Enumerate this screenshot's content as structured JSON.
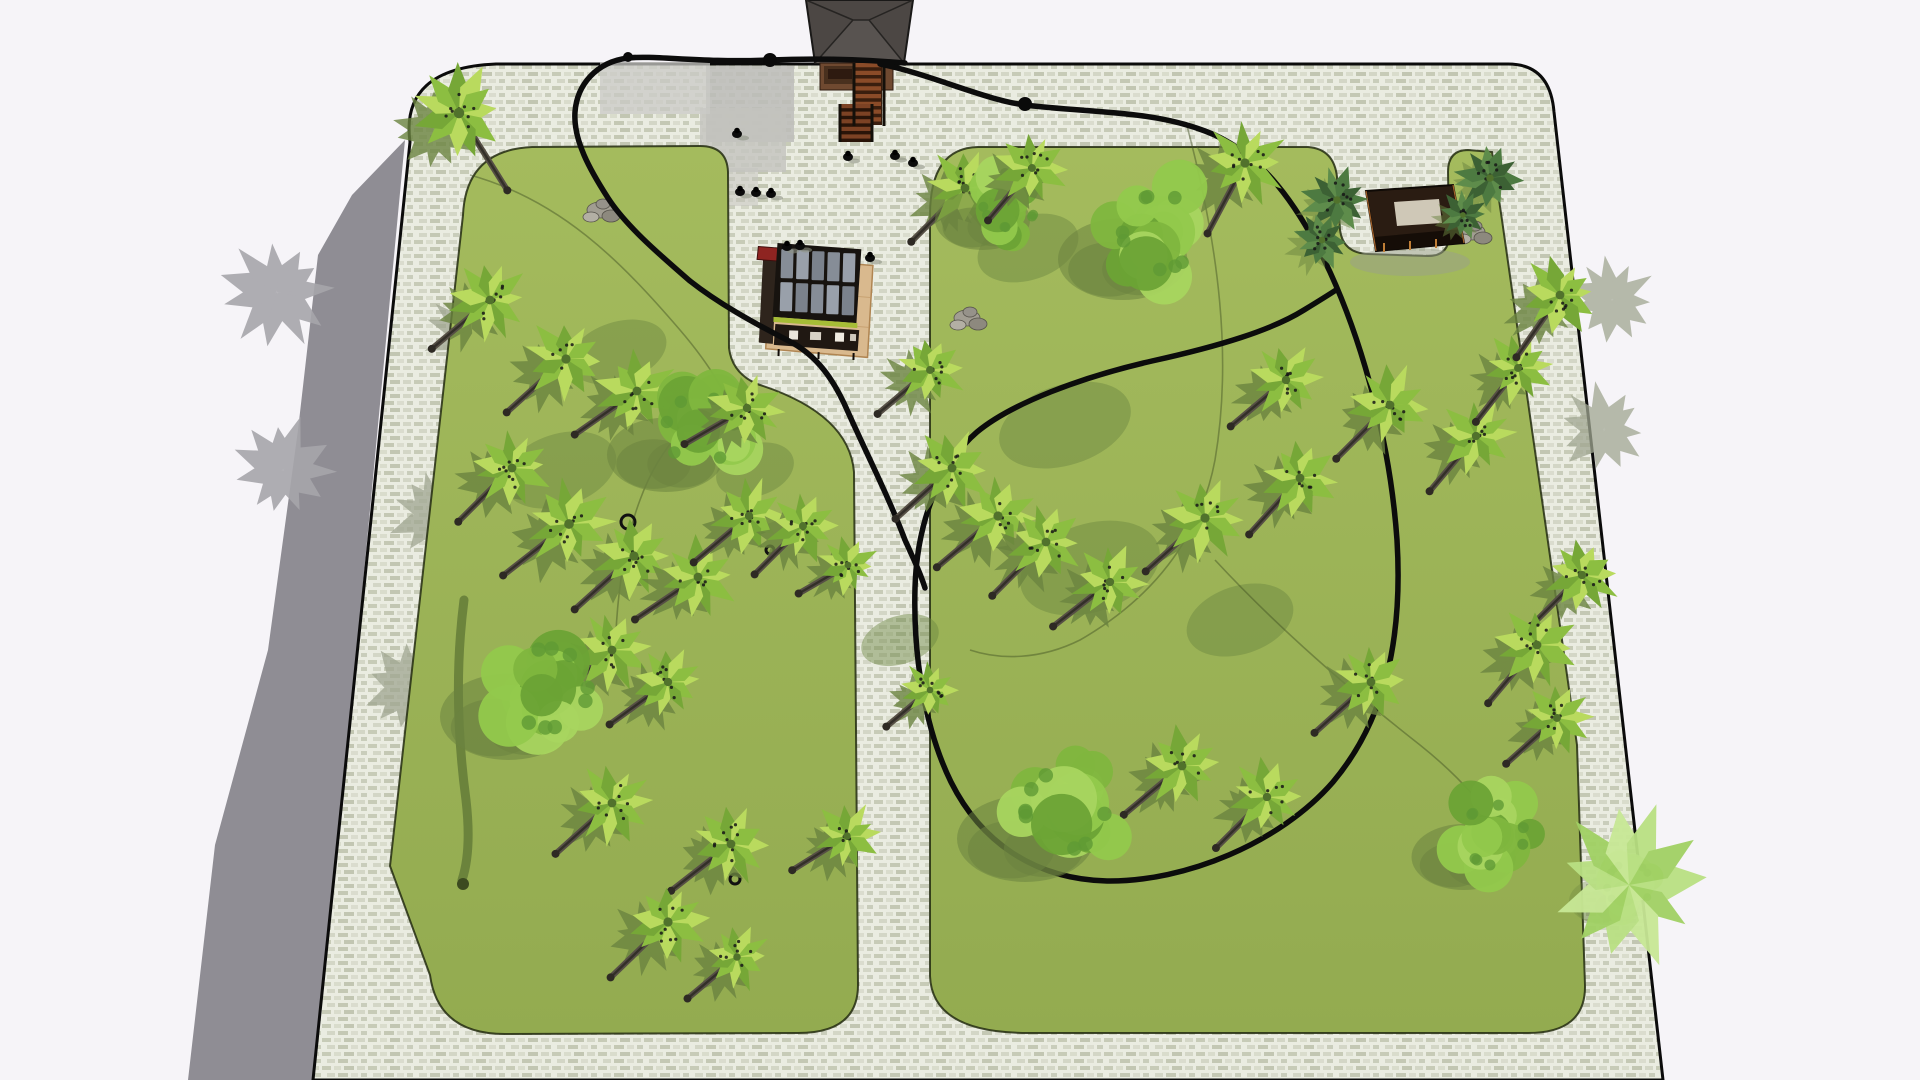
{
  "scene": {
    "canvas": {
      "w": 1920,
      "h": 1080,
      "background": "#f6f4f8"
    },
    "colors": {
      "plaza_outline": "#0b0b0b",
      "paving_base": "#eaece1",
      "paving_dash1": "#c7cbb7",
      "paving_dash2": "#d9dccc",
      "lawn_top": "#a4bb5d",
      "lawn_bottom": "#93ab50",
      "lawn_edge": "#232c10",
      "ground_shadow": "#8f8d94",
      "gray_tree": "#a7a6ab",
      "tree_shadow": "#6b8440",
      "paving_shadow": "#a0a691",
      "route": "#0c0c0c",
      "thin_path": "#3f4d22",
      "trunk": "#564f45",
      "trunk_dark": "#332f29"
    },
    "ground_shadow_path": "M405,140 L352,195 318,255 298,430 268,650 215,845 188,1080 L316,1080 Z",
    "plaza_path": "M496,64 L1508,64 Q1550,64 1554,112 L1663,1080 L313,1080 L410,142 Q400,68 496,64 Z",
    "lawns": [
      {
        "name": "left-lawn",
        "path": "M532,147 L700,146 Q727,146 728,172 L729,348 Q732,373 757,384 Q849,413 854,472 L858,985 Q858,1033 798,1033 L505,1034 Q438,1034 430,975 L390,866 L463,215 Q466,150 532,147 Z"
      },
      {
        "name": "right-lawn",
        "path": "M978,147 L1308,147 Q1334,149 1337,177 L1340,230 Q1343,253 1368,254 L1428,256 Q1449,256 1449,235 L1448,172 Q1448,150 1468,150 L1492,152 L1502,220 L1577,745 L1585,985 Q1586,1033 1528,1033 L1032,1033 Q932,1034 930,976 L930,215 Q930,148 978,147 Z"
      }
    ],
    "paving_patches": [
      [
        706,
        66,
        88,
        76,
        "#bcbcb8",
        0.85
      ],
      [
        700,
        108,
        86,
        64,
        "#c3c3be",
        0.8
      ],
      [
        600,
        62,
        110,
        52,
        "#cacac6",
        0.75
      ],
      [
        706,
        168,
        52,
        38,
        "#c5c5c0",
        0.55
      ]
    ],
    "paving_tree_shadows": [
      [
        470,
        335
      ],
      [
        435,
        515
      ],
      [
        408,
        688
      ],
      [
        1604,
        430
      ],
      [
        1612,
        300
      ]
    ],
    "shadow_patches": [
      [
        1065,
        425,
        68,
        40
      ],
      [
        1090,
        568,
        72,
        44
      ],
      [
        560,
        470,
        58,
        36
      ],
      [
        618,
        352,
        50,
        30
      ],
      [
        1028,
        248,
        52,
        32
      ],
      [
        755,
        470,
        40,
        26
      ],
      [
        1240,
        620,
        55,
        34
      ],
      [
        900,
        640,
        40,
        24
      ]
    ],
    "streak": {
      "path": "M464,600 C455,670 458,740 466,800 C470,835 468,862 462,880",
      "width": 9,
      "color": "#5c7434",
      "blob": [
        463,
        884,
        6
      ]
    },
    "thin_paths": [
      "M470,175 C560,200 620,260 680,330 C710,365 725,392 733,412",
      "M745,388 C695,408 660,445 640,500 C622,548 615,610 615,670",
      "M1186,122 C1220,250 1232,360 1215,460 C1200,540 1150,600 1080,640 C1040,660 1000,660 970,650",
      "M1215,560 C1280,630 1350,690 1420,745 C1460,777 1490,810 1510,850"
    ],
    "routes": [
      "M905,63 C870,60 820,58 770,60 C700,63 655,55 628,58 C596,62 577,85 575,112 C573,140 590,170 608,198 C626,226 660,255 690,281 C718,303 752,322 787,340 C818,355 835,382 848,412 C865,450 890,500 905,540 C915,562 921,575 925,588",
      "M880,64 C930,74 985,100 1025,105 C1090,113 1150,110 1205,131 C1262,152 1300,208 1330,272 C1362,342 1390,440 1397,540 C1403,640 1385,720 1333,782 C1280,843 1185,882 1107,881 C1032,879 980,840 951,782 C926,731 913,660 915,588 C917,518 942,462 977,432 C1012,403 1082,377 1152,361 C1220,346 1272,330 1304,310 C1322,299 1330,294 1336,290"
    ],
    "route_width": 5.5,
    "route_blobs": [
      [
        770,
        60,
        7
      ],
      [
        1025,
        104,
        7
      ],
      [
        628,
        57,
        5
      ]
    ],
    "trees": [
      [
        459,
        113,
        48,
        "palm",
        58
      ],
      [
        490,
        300,
        40,
        "palm",
        140
      ],
      [
        566,
        359,
        42,
        "palm",
        138
      ],
      [
        637,
        391,
        40,
        "palm",
        145
      ],
      [
        700,
        430,
        62,
        "canopy",
        0
      ],
      [
        747,
        408,
        38,
        "palm",
        150
      ],
      [
        512,
        468,
        40,
        "palm",
        135
      ],
      [
        569,
        524,
        44,
        "palm",
        142
      ],
      [
        634,
        556,
        42,
        "palm",
        138
      ],
      [
        698,
        577,
        40,
        "palm",
        146
      ],
      [
        749,
        516,
        38,
        "palm",
        140
      ],
      [
        803,
        526,
        36,
        "palm",
        135
      ],
      [
        848,
        565,
        30,
        "palm",
        150
      ],
      [
        612,
        650,
        40,
        "palm",
        140
      ],
      [
        668,
        682,
        38,
        "palm",
        144
      ],
      [
        548,
        688,
        72,
        "canopy",
        0
      ],
      [
        612,
        803,
        40,
        "palm",
        138
      ],
      [
        731,
        844,
        40,
        "palm",
        142
      ],
      [
        668,
        922,
        42,
        "palm",
        136
      ],
      [
        737,
        957,
        34,
        "palm",
        140
      ],
      [
        847,
        836,
        34,
        "palm",
        148
      ],
      [
        930,
        370,
        36,
        "palm",
        140
      ],
      [
        965,
        188,
        40,
        "palm",
        135
      ],
      [
        1010,
        200,
        50,
        "canopy",
        0
      ],
      [
        1032,
        168,
        36,
        "palm",
        130
      ],
      [
        1245,
        163,
        42,
        "palm",
        118
      ],
      [
        1160,
        232,
        68,
        "canopy",
        0
      ],
      [
        952,
        468,
        40,
        "palm",
        138
      ],
      [
        998,
        516,
        42,
        "palm",
        140
      ],
      [
        1046,
        542,
        40,
        "palm",
        135
      ],
      [
        1110,
        582,
        38,
        "palm",
        142
      ],
      [
        1205,
        518,
        42,
        "palm",
        138
      ],
      [
        1300,
        478,
        40,
        "palm",
        132
      ],
      [
        1286,
        380,
        38,
        "palm",
        140
      ],
      [
        1390,
        405,
        40,
        "palm",
        135
      ],
      [
        1476,
        436,
        38,
        "palm",
        130
      ],
      [
        1518,
        368,
        36,
        "palm",
        128
      ],
      [
        1560,
        295,
        40,
        "palm",
        125
      ],
      [
        1582,
        575,
        38,
        "palm",
        135
      ],
      [
        1537,
        645,
        40,
        "palm",
        130
      ],
      [
        1557,
        718,
        36,
        "palm",
        138
      ],
      [
        1182,
        766,
        40,
        "palm",
        140
      ],
      [
        1267,
        797,
        38,
        "palm",
        135
      ],
      [
        1371,
        682,
        40,
        "palm",
        138
      ],
      [
        1065,
        810,
        72,
        "canopy",
        0
      ],
      [
        1494,
        835,
        55,
        "canopy",
        0
      ],
      [
        1629,
        885,
        80,
        "fern",
        0
      ],
      [
        930,
        690,
        30,
        "palm",
        140
      ],
      [
        1337,
        200,
        34,
        "bush",
        0
      ],
      [
        1322,
        240,
        30,
        "bush",
        0
      ],
      [
        1490,
        178,
        34,
        "bush",
        0
      ],
      [
        1463,
        215,
        26,
        "bush",
        0
      ],
      [
        277,
        292,
        55,
        "gray",
        0
      ],
      [
        283,
        470,
        52,
        "gray",
        0
      ]
    ],
    "rocks": [
      [
        600,
        210
      ],
      [
        967,
        318
      ],
      [
        1472,
        232
      ]
    ],
    "rings": [
      [
        628,
        522,
        7
      ],
      [
        770,
        550,
        4
      ],
      [
        735,
        879,
        5
      ]
    ],
    "people": [
      [
        737,
        134
      ],
      [
        848,
        157
      ],
      [
        895,
        156
      ],
      [
        913,
        163
      ],
      [
        740,
        192
      ],
      [
        756,
        193
      ],
      [
        771,
        194
      ],
      [
        870,
        258
      ],
      [
        787,
        247
      ],
      [
        800,
        246
      ]
    ],
    "structures": {
      "entrance": {
        "shapes": [
          {
            "d": "M806,0 L913,0 L904,63 L815,63 Z",
            "fill": "#4c4744",
            "stroke": "#1a1918",
            "sw": 2
          },
          {
            "d": "M815,63 L853,20 L869,20 L904,63 Z",
            "fill": "#585350"
          },
          {
            "d": "M815,63 L853,20 M904,63 L869,20 M853,20 L869,20 M806,0 L853,20 M913,0 L869,20",
            "stroke": "#262422",
            "sw": 1.5
          },
          {
            "d": "M820,63 L893,63 L893,90 L820,90 Z",
            "fill": "#6f4930",
            "stroke": "#2e1a10",
            "sw": 1
          },
          {
            "d": "M824,66 L860,66 L860,84 L824,84 Z",
            "fill": "#49301e"
          },
          {
            "d": "M828,69 L852,69 L852,79 L828,79 Z",
            "fill": "#2e1a10"
          }
        ],
        "stairs": [
          {
            "x": 854,
            "y": 63,
            "w": 28,
            "h": 62,
            "n": 8,
            "c1": "#8a4b28",
            "c2": "#3a1e0e"
          },
          {
            "x": 840,
            "y": 104,
            "w": 32,
            "h": 38,
            "n": 5,
            "c1": "#7c4224",
            "c2": "#2a1408"
          }
        ],
        "rails": {
          "d": "M884,63 L884,126 M854,63 L854,126 M840,104 L840,142 M872,104 L872,142",
          "stroke": "#14100a",
          "sw": 3
        }
      },
      "kiosk": {
        "rotate": [
          1.5,
          815,
          300
        ],
        "shapes": [
          {
            "d": "M770,258 L872,264 L869,356 L767,350 Z",
            "fill": "#d9b98e",
            "stroke": "#b08552",
            "sw": 1.5
          },
          {
            "d": "M770,290 L870,296 M769,320 L869,326",
            "stroke": "#c8a272",
            "sw": 1
          },
          {
            "d": "M762,258 L776,259 L774,345 L760,344 Z",
            "fill": "#2e241c"
          },
          {
            "d": "M757,248 L777,249 L776,262 L756,261 Z",
            "fill": "#8e2421",
            "stroke": "#3f0e0d",
            "sw": 1
          },
          {
            "d": "M776,244 L860,248 L857,322 L773,318 Z",
            "fill": "#17130f"
          },
          {
            "d": "M774,318 L858,322 L858,327 L774,323 Z",
            "fill": "#a6bd36"
          },
          {
            "d": "M776,325 L860,329 L859,350 L775,346 Z",
            "fill": "#201812"
          },
          {
            "d": "M790,331 h9 v9 h-9 Z",
            "fill": "#eae5db"
          },
          {
            "d": "M811,332 h11 v8 h-11 Z",
            "fill": "#d9d3c7"
          },
          {
            "d": "M836,332 h9 v9 h-9 Z",
            "fill": "#f0ebe1"
          },
          {
            "d": "M851,333 h6 v7 h-6 Z",
            "fill": "#cfc9bd"
          },
          {
            "d": "M780,350 L780,357 M820,352 L820,359 M855,352 L855,359",
            "stroke": "#110c08",
            "sw": 2
          }
        ],
        "glass": {
          "x": 780,
          "y": 250,
          "cols": 5,
          "rows": 2,
          "cw": 15.5,
          "ch": 33,
          "fills": [
            "#868d97",
            "#99a0aa",
            "#7b828c"
          ]
        }
      },
      "pavilion": {
        "shapes": [
          {
            "d": "M1350,262 a60,14 0 1 0 120,0 a60,14 0 1 0 -120,0",
            "fill": "#99a08c",
            "op": 0.5
          },
          {
            "d": "M1366,191 L1453,185 L1464,243 L1376,251 Z",
            "fill": "#2a1c12",
            "stroke": "#0f0a06",
            "sw": 2
          },
          {
            "d": "M1394,202 L1439,199 L1442,223 L1397,226 Z",
            "fill": "#cfc8b7"
          },
          {
            "d": "M1374,237 L1462,229 L1464,243 L1376,251 Z",
            "fill": "#150d07"
          },
          {
            "d": "M1366,191 L1376,251 M1453,185 L1464,243",
            "stroke": "#a4622a",
            "sw": 1.2
          },
          {
            "d": "M1384,243 L1384,252 M1410,241 L1410,250 M1436,239 L1436,248",
            "stroke": "#bf7e36",
            "sw": 2
          }
        ]
      }
    }
  }
}
